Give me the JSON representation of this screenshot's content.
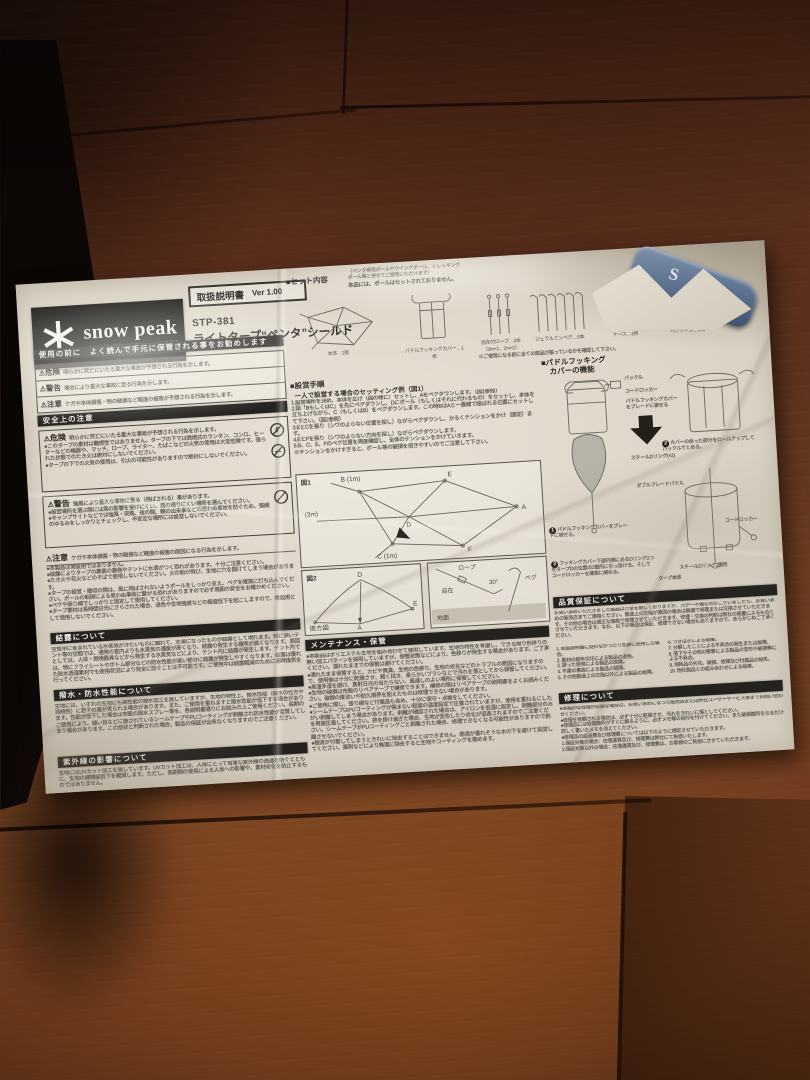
{
  "colors": {
    "wood": "#6d3c22",
    "paper": "#ddd6c9",
    "banner": "#23221f",
    "logo_bg": "#161412",
    "blue_case": "#5b6f8c"
  },
  "icons": {
    "warning": "⚠",
    "bullet": "●",
    "square": "■"
  },
  "header": {
    "brand": "snow peak",
    "tagline": "outdoor lifestyle creator",
    "since": "since1958",
    "manual_label": "取扱説明書",
    "version": "Ver 1.00",
    "model": "STP-381",
    "product_name": "ライトタープ“ペンタ”シールド"
  },
  "set_contents": {
    "title": "■セット内容",
    "note1": "（ペンタ専用ポールやウイングポール、トレッキング",
    "note2": "ポール等と併せてご使用いただけます）",
    "note_bold": "本品には、ポールはセットされておりません。",
    "items": [
      {
        "label": "本体…1張"
      },
      {
        "label": "パドルフッキングカバー…1枚"
      },
      {
        "label": "自在付ロープ…3本（3m×1、2m×2）"
      },
      {
        "label": "ジュラルミンペグ…6本"
      },
      {
        "label": "ケース…1枚"
      },
      {
        "label": "ペグケース…1枚"
      }
    ],
    "footnote": "※ご使用になる前に全ての部品が揃っているかを確認して下さい。"
  },
  "safety": {
    "notice_banner": "使用の前に　よく読んで手元に保管される事をお勧めします",
    "levels": [
      {
        "label": "危険",
        "text": "明らかに死亡にいたる重大な事故が予想される行為を示します。"
      },
      {
        "label": "警告",
        "text": "場合により重大な事故に至る行為を示します。"
      },
      {
        "label": "注意",
        "text": "ケガや本体損傷・物の破損など軽度の被害が予想される行為を示します。"
      }
    ],
    "banner": "安全上の注意",
    "danger": {
      "label": "危険",
      "intro": "明らかに死亡にいたる重大な事故が予想される行為を示します。",
      "bullets": [
        "●このタープの素材は難燃性ではありません。タープの下では燃焼式のランタン、コンロ、ヒーターなどの機器や、マッチ、ロープ、ライター、たばこなどの火気の使用は大変危険です。張られた状態でのたき火は絶対にしないでください。",
        "●タープの下での火気の使用は、引火の可能性がありますので絶対にしないでください。"
      ]
    },
    "warning": {
      "label": "警告",
      "intro": "強風により重大な事故に至る（飛ばされる）事があります。",
      "bullets": [
        "●設営場所を選ぶ際には風の影響を受けにくい、風の通りにくい場所を選んでください。",
        "●キャンプサイトなどでは強風・突風、夜の間、朝の出来事などの思わぬ事故を防ぐため、張綱のゆるみをしっかりとチェックし、不安定な場所には設営しないでください。"
      ]
    },
    "caution": {
      "label": "注意",
      "intro": "ケガや本体損傷・物の破損など軽度の被害の原因になる行為を示します。",
      "bullets": [
        "●本製品は常設用ではありません。",
        "●結露によりタープの裏面の裏側やテントに水滴がつく恐れがあります。十分ご注意ください。",
        "●たき火や花火などのそばで使用しないでください。火の粉が飛び、生地に穴を開けてしまう場合があります。",
        "●タープの設営・撤収の際は、風に飛ばされないようポールをしっかり支え、ペグを確実に打ち込んでください。ポールの転倒による思わぬ事故に繋がる恐れがありますので必ず周囲の安全をお確かめください。",
        "●ペグや張り綱でしっかりと固定して使用してください。",
        "●タープ素材は長時間日光にさらされた場合、退色や生地強度などの極度低下を起こしますので、常設用として使用しないでください。"
      ]
    },
    "condensation": {
      "banner": "結露について",
      "text": "空気中に含まれている水蒸気が冷たいものに触れて、水滴になったものが結露として現れます。特に狭いテント等の空間では、通常の室内よりも水蒸気の濃度が高くなり、結露の発生する確率が高くなります。原因としては、人体・燃焼器具などから発生する水蒸気などにより、テント内に結露が発生します。テント内では、特にフライシートやボトム部分などの防水性能が高い部分に結露が発生しやすくなります。結露は優れた防水透湿素材でも使用状況により完全に防ぐことは不可能です。ご使用中は結露軽減のために適時換気を行ってください。"
    },
    "water_repellency": {
      "banner": "撥水・防水性能について",
      "text": "生地には、いずれの生地にも高性能の撥水加工を施していますが、生地の特性上、撥水性能（撥水の仕方や持続性）に若干の差が見られる場合があります。また、ご使用を重ねますと撥水性能が低下する場合があります。性能が低下した場合は市販の撥水スプレー等を、各説明書通りにお試みの上ご使用ください。長期のご使用により、縫い目などに施されているシームテープやPUコーティングが剥離され防水性能が変質してしまう場合があります。この症状と判断された場合、製品の保証が出来なくなりますのでご注意ください。"
    },
    "uv": {
      "banner": "紫外線の影響について",
      "text": "生地にはUVカット加工を施しています。UVカット加工は、人体にとって有害な紫外線の透過を防ぐとともに、生地の諸機能低下を軽減します。ただし、長期間の使用による人体への影響や、素材劣化を防止するものではありません。"
    }
  },
  "setup": {
    "title": "■設営手順",
    "subtitle": "一人で設営する場合のセッティング例（図1）",
    "steps": [
      "1.設営場所を決め、本体を広げ（図の様に）セットし、Aをペグダウンします。（図1参照）",
      "2.図「BもしくはC」を先にペグダウンし、Dにポール（もしくはそれに代わるもの）をセットし、本体を立ち上げながら、C（もしくはB）をペグダウンします。この時BはAと一直線で結ばれる位置にセットして下さい。（図2参照）",
      "3.EとCを張り（シワのよらない位置を探し）ながらペグダウンし、かるくテンションをかけ（固定）ます。",
      "4.EとFを張り（シワのよらない方向を探し）ながらペグダウンします。",
      "5.B、C、E、Fのペグ位置を再度確認し、全体のテンションをかけていきます。",
      "※テンションをかけすぎると、ポール等の破損を招きやすいのでご注意して下さい。"
    ]
  },
  "figures": {
    "fig1": {
      "label": "図1",
      "b": "B (1m)",
      "e": "E",
      "three_m": "(3m)",
      "d": "D",
      "a": "A",
      "c": "C (1m)",
      "f": "F"
    },
    "fig2": {
      "label": "図2",
      "rear": "後方図",
      "d": "D",
      "a": "A",
      "e": "E"
    },
    "peg": {
      "rope": "ロープ",
      "angle": "30°",
      "adjuster": "自在",
      "peg": "ペグ",
      "ground": "地面"
    }
  },
  "maintenance": {
    "banner": "メンテナンス・保管",
    "bullets": [
      "●本製品はポリエステル生地を組み合わせて使用しています。生地の特性を考慮し、できる限り色移りの無い加工パターンを採用していますが、保管状態などにより、色移りが発生する場合があります。ご了承ください。濡れたままでの保管は避けてください。",
      "●濡れたまま保管すると、カビや異臭、生地の色移り、生地の劣化などのトラブルの原因になりますので、使用後は十分に乾燥させ、軽く拭き、柔らかいブラシなどで汚れを落としてから保管してください。",
      "●高温多湿を避け、直射日光の当たらない、風通しのよい場所に保管してください。",
      "●生地の破損は市販のリペアテープで補修できます。補修の際はリペアテープの説明書をよくお読みください。破損の度合いや耐久限界を超えたものは修理できない場合があります。",
      "●ご使用に際し、張り綱など付属品も含め、十分に保守・点検をしてください。",
      "●シームテープはPUコーティングが傷まない程度の温度設定で圧着されていますが、使用を重ねるにしたがい剥離してしまう場合があります。剥離が確認された場合は、アイロンを低温に設定し、剥離部分のみを再度圧着してください。熱を掛け過ぎた場合、生地が変色したり劣化が促進されますのでご注意ください。シームテープがPUコーティングごと剥離された場合、修理できなくなる可能性がありますので剥離させないでください。",
      "●樹液が付着してしまうときれいに除去することはできません。樹液が垂れそうな木の下を避けて設営してください。薬剤などにより無理に除去すると生地やコーティングを傷めます。"
    ]
  },
  "paddle": {
    "title1": "■パドルフッキング",
    "title2": "カバーの機能",
    "labels": {
      "buckle": "バックル",
      "cord1": "コードロッカー",
      "cover_note": "パドルフッキングカバーをブレードに被せる",
      "dring": "スチールDリング(×2)",
      "blade": "ダブルブレードパドル",
      "cord2": "コードロッカー",
      "dring2": "スチールDリング2箇所",
      "tarp": "タープ本体"
    },
    "steps": [
      {
        "n": "1",
        "text": "パドルフッキングカバーをブレードに被せる。"
      },
      {
        "n": "2",
        "text": "カバーの余った部分をロールアップしてバックルでとめる。"
      },
      {
        "n": "3",
        "text": "フッキングカバー下部内側にあるDリング2つをタープDの位置の2箇所に引っ掛ける。そしてコードロッカーを確実に締める。"
      }
    ]
  },
  "quality": {
    "banner": "品質保証について",
    "intro": "お買い求めいただきました製品は万全を期しておりますが、万が一不備な点がございましたら、お買い求めの販売店までご連絡ください。製造上の欠陥が原因の場合は無償で修理または交換させていただきます。その他の場合は適正な価格で修理させていただきます。修理・交換の判断は弊社の裁量によるものとさせていただきます。なお、以下の場合は保証、修理できない場合もありますので、あらかじめご了承ください。",
    "list_left": [
      "1. 取扱説明書に従わなかったり乱暴に使用した場合。",
      "2. 素材の経年劣化による製品の退色。",
      "3. 誤った使用による製品の故障。",
      "4. 不慮の事故による製品の故障。",
      "5. その他製造上の欠陥以外による製品の故障。"
    ],
    "list_right": [
      "6. つぎはぎによる故障。",
      "7. 分解したことによる不具合の発生または故障。",
      "8. 落下やその他の衝撃による製品の変形や破損等による不具合。",
      "9. 消耗品の劣化、破損、故障及び付属品の紛失。",
      "10. 他社製品との組み合わせによる故障。"
    ]
  },
  "repair": {
    "banner": "修理について",
    "bullets": [
      "●本格的な修理が必要な場合は、お買い求めになった販売店または弊社ユーザーサービス係までお問い合わせください。",
      "●修理を依頼される場合は、必ず十分に乾燥させ、汚れをきれいに落としてください。",
      "●修理品には修理箇所がすぐに解るように、必ずメモ等の目印を付けてください。また破損箇所をなるだけ詳しく書いたメモを添えてください。",
      "●修理品の返送費及び修理費については以下のように規定させていただきます。",
      "1.保証対象の場合：往復運賃及び、修理費は弊社にて負担いたします。",
      "2.保証対象以外の場合：往復運賃及び、修理費は、お客様のご負担にさせていただきます。"
    ]
  },
  "blue_object": {
    "letters": "S"
  }
}
